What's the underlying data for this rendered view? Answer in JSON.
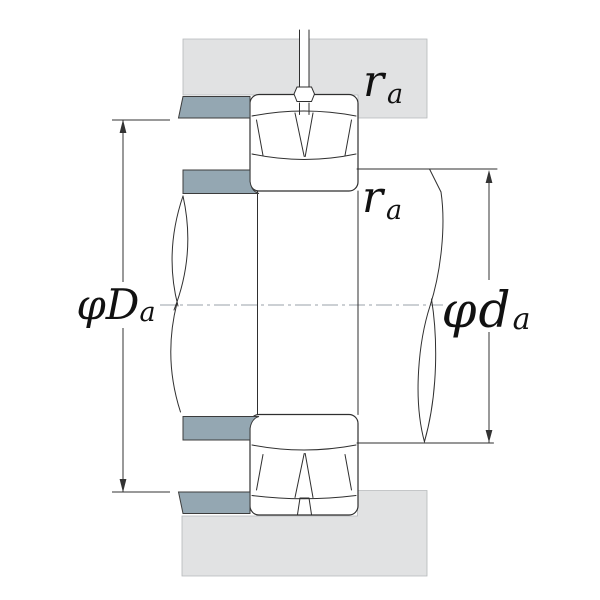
{
  "figure": {
    "labels": {
      "fillet_radius_top": {
        "base": "r",
        "sub": "a"
      },
      "fillet_radius_mid": {
        "base": "r",
        "sub": "a"
      },
      "housing_abutment_diameter": {
        "base": "φD",
        "sub": "a"
      },
      "shaft_abutment_diameter": {
        "base": "φd",
        "sub": "a"
      }
    },
    "colors": {
      "background": "#ffffff",
      "housing_fill": "#e1e2e3",
      "abutment_ring_fill": "#94a7b2",
      "outline": "#2f2f2f",
      "centerline": "#9aa0a8",
      "dimension": "#333333",
      "text": "#111111"
    }
  }
}
